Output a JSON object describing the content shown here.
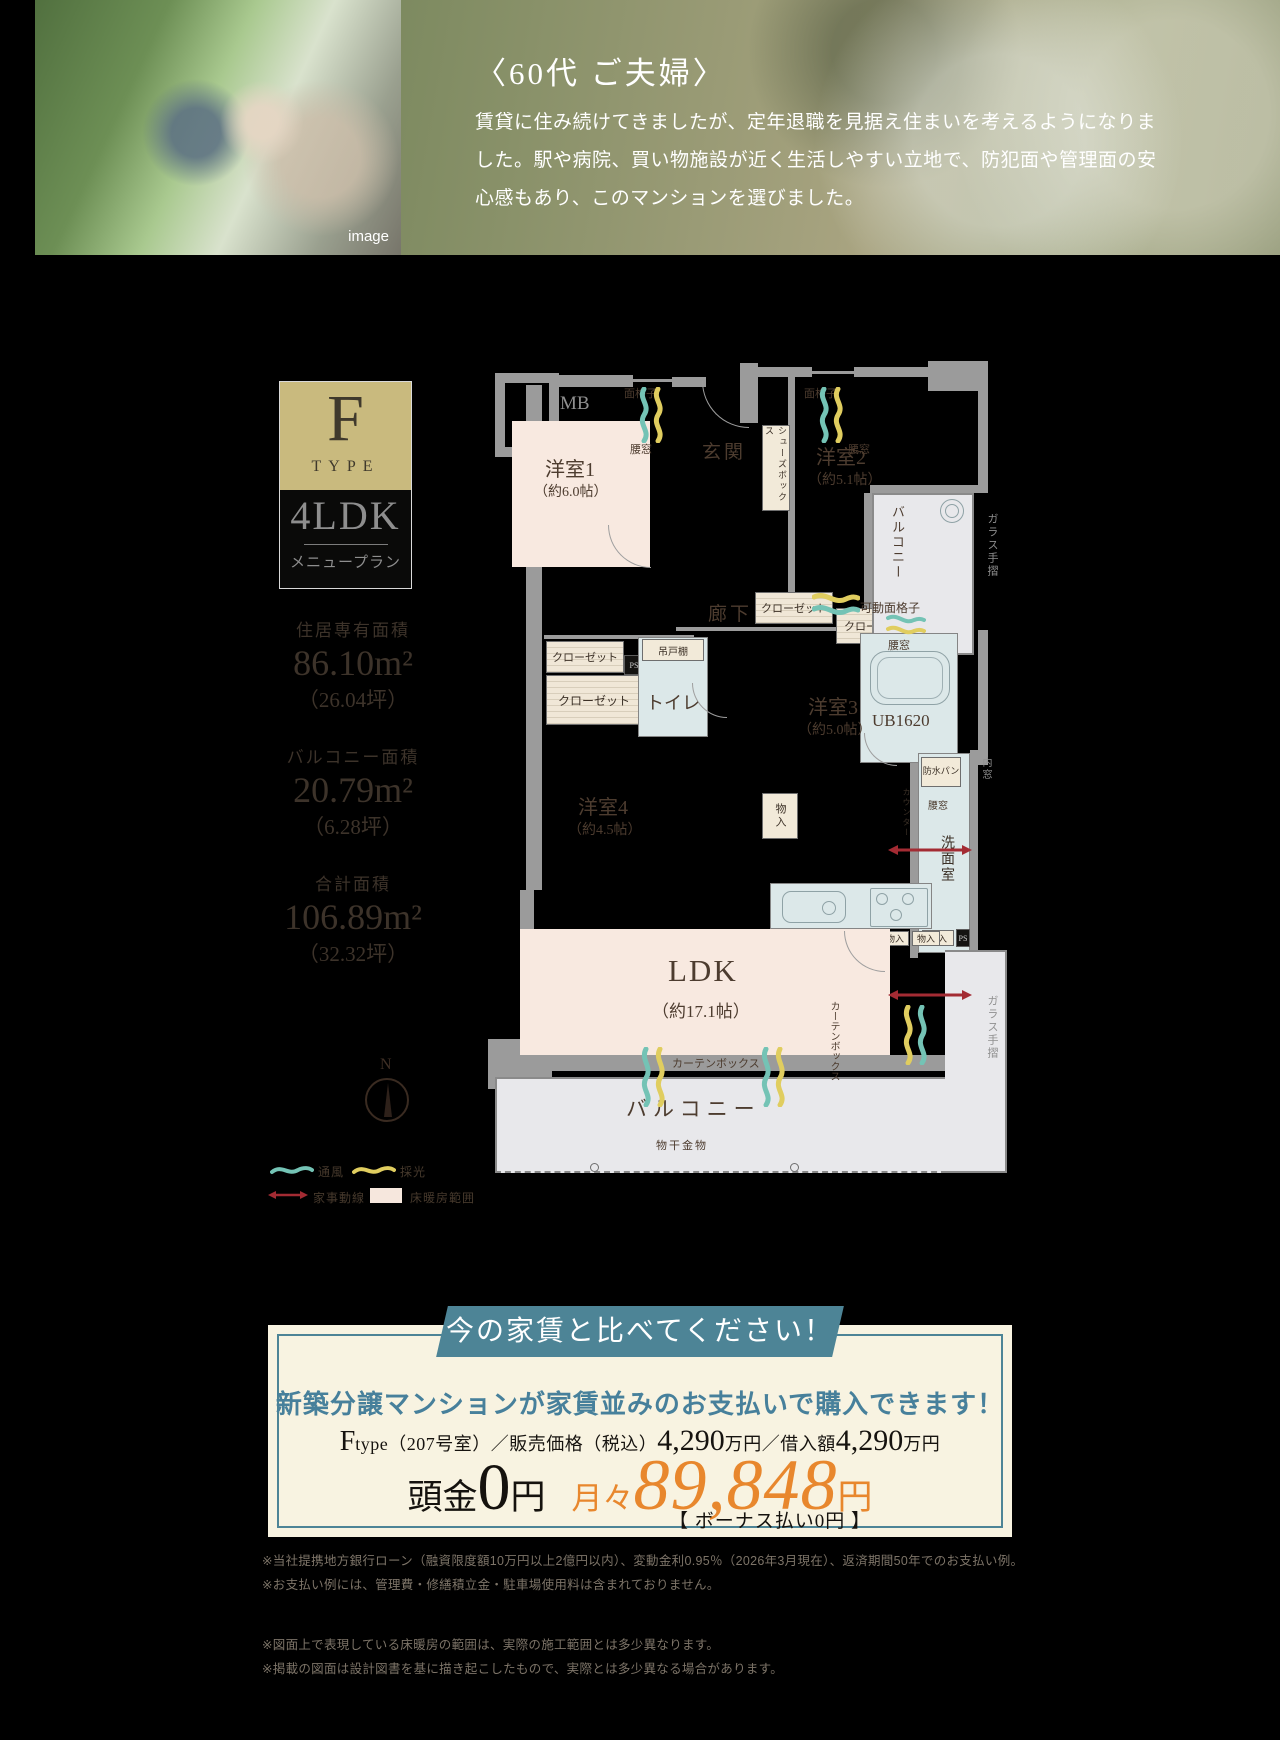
{
  "hero": {
    "caption": "image",
    "title": "〈60代 ご夫婦〉",
    "body": "賃貸に住み続けてきましたが、定年退職を見据え住まいを考えるようになりました。駅や病院、買い物施設が近く生活しやすい立地で、防犯面や管理面の安心感もあり、このマンションを選びました。"
  },
  "badge": {
    "letter": "F",
    "type_word": "TYPE",
    "plan": "4LDK",
    "menu": "メニュープラン"
  },
  "areas": {
    "exclusive_label": "住居専有面積",
    "exclusive_value": "86.10m²",
    "exclusive_tsubo": "（26.04坪）",
    "balcony_label": "バルコニー面積",
    "balcony_value": "20.79m²",
    "balcony_tsubo": "（6.28坪）",
    "total_label": "合計面積",
    "total_value": "106.89m²",
    "total_tsubo": "（32.32坪）"
  },
  "compass_n": "N",
  "legend": {
    "wind": "通風",
    "light": "採光",
    "housework": "家事動線",
    "heating": "床暖房範囲"
  },
  "floorplan": {
    "mb": "MB",
    "lattice": "面格子",
    "waist_window": "腰窓",
    "entrance": "玄関",
    "shoe_box": "シューズボックス",
    "hallway": "廊下",
    "closet": "クローゼット",
    "ps": "PS",
    "hanging_shelf": "吊戸棚",
    "toilet": "トイレ",
    "storage": "物入",
    "room1": "洋室1",
    "room1_size": "（約6.0帖）",
    "room2": "洋室2",
    "room2_size": "（約5.1帖）",
    "room3": "洋室3",
    "room3_size": "（約5.0帖）",
    "room4": "洋室4",
    "room4_size": "（約4.5帖）",
    "ldk": "LDK",
    "ldk_size": "（約17.1帖）",
    "balcony": "バルコニー",
    "glass_handrail": "ガラス手摺",
    "movable_lattice": "可動面格子",
    "unit_bath": "UB1620",
    "waterproof_pan": "防水パン",
    "counter": "カウンター",
    "washroom": "洗面室",
    "inner_window": "内窓",
    "curtain_box": "カーテンボックス",
    "laundry_hardware": "物干金物"
  },
  "offer": {
    "banner": "今の家賃と比べてください！",
    "headline": "新築分譲マンションが家賃並みのお支払いで購入できます！",
    "spec_f": "F",
    "spec_type": "type（207号室）／販売価格（税込）",
    "price1": "4,290",
    "unit1": "万円",
    "loan_label": "／借入額",
    "price2": "4,290",
    "unit2": "万円",
    "down_label": "頭金",
    "down_value": "0",
    "down_unit": "円",
    "monthly_label": "月々",
    "monthly_value": "89,848",
    "monthly_unit": "円",
    "bonus": "【 ボーナス払い0円 】"
  },
  "notes_loan": [
    "※当社提携地方銀行ローン（融資限度額10万円以上2億円以内）、変動金利0.95％（2026年3月現在）、返済期間50年でのお支払い例。",
    "※お支払い例には、管理費・修繕積立金・駐車場使用料は含まれておりません。"
  ],
  "notes_plan": [
    "※図面上で表現している床暖房の範囲は、実際の施工範囲とは多少異なります。",
    "※掲載の図面は設計図書を基に描き起こしたもので、実際とは多少異なる場合があります。"
  ],
  "colors": {
    "accent_teal": "#4d8496",
    "headline_teal": "#47809b",
    "accent_orange": "#e8872d",
    "wave_wind": "#74c3b5",
    "wave_light": "#e0cd5f",
    "arrow_red": "#a32b33",
    "floor_heating_fill": "#f8e9e0",
    "badge_gold": "#c9ba7e",
    "offer_bg": "#f8f3e1"
  }
}
